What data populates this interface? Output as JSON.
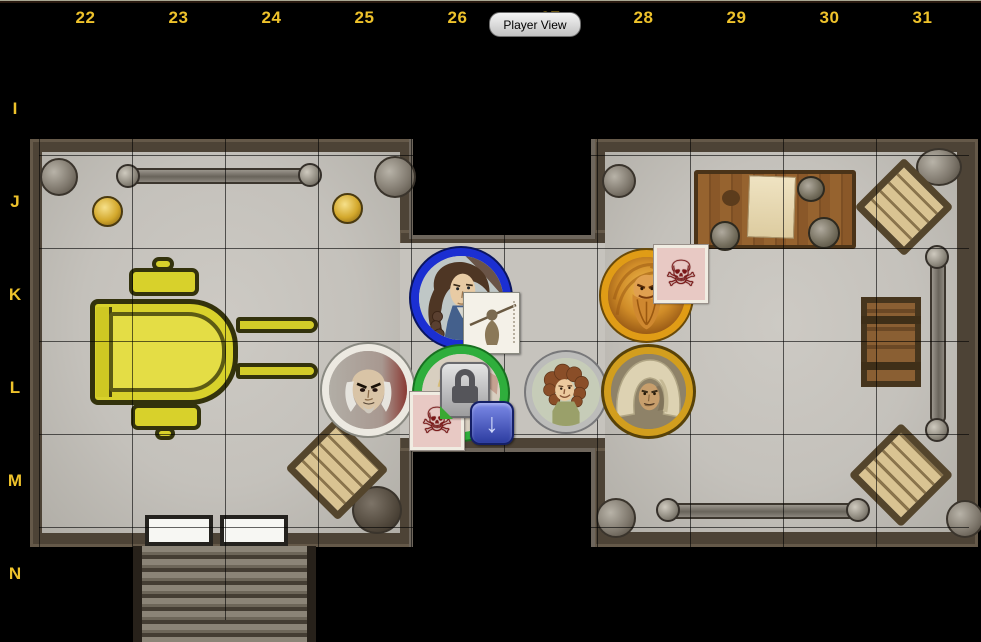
{
  "toolbar": {
    "player_view_label": "Player View"
  },
  "ruler": {
    "columns": [
      "22",
      "23",
      "24",
      "25",
      "26",
      "27",
      "28",
      "29",
      "30",
      "31"
    ],
    "rows": [
      "I",
      "J",
      "K",
      "L",
      "M",
      "N"
    ],
    "label_color": "#eec22b"
  },
  "icons": {
    "skull_badge": "☠",
    "download_badge": "↓",
    "lock_badge": "padlock-shape",
    "figure_badge": "spear-figure-card"
  },
  "map": {
    "rooms": [
      "left-hall-with-piano",
      "central-corridor",
      "right-hall-with-table"
    ],
    "furniture": [
      "piano",
      "piano-stools",
      "wooden-table",
      "parchment",
      "mugs",
      "baskets",
      "crate",
      "railings",
      "lamps",
      "corner-stones",
      "double-doors",
      "staircase"
    ],
    "floor_color": "#c6c3bd",
    "wall_color": "#4d4336",
    "grid_color": "#000000"
  },
  "tokens": [
    {
      "id": "braided-woman",
      "cell": "K26",
      "ring_color": "#1b2fd2",
      "badges": [
        "figure-card"
      ]
    },
    {
      "id": "wild-bearded-man",
      "cell": "K28",
      "ring_color": "#e09c16",
      "badges": [
        "skull-card"
      ]
    },
    {
      "id": "bald-villain",
      "cell": "L25",
      "ring_color": "#ece9e1",
      "badges": []
    },
    {
      "id": "locked-token",
      "cell": "L26",
      "ring_color": "#2fae3c",
      "badges": [
        "skull-card",
        "lock-card",
        "download-arrow"
      ]
    },
    {
      "id": "curly-haired-halfling",
      "cell": "L27",
      "ring_color": "#bcbcba",
      "badges": []
    },
    {
      "id": "hooded-man",
      "cell": "L28",
      "ring_color": "#d29e1e",
      "badges": []
    }
  ]
}
